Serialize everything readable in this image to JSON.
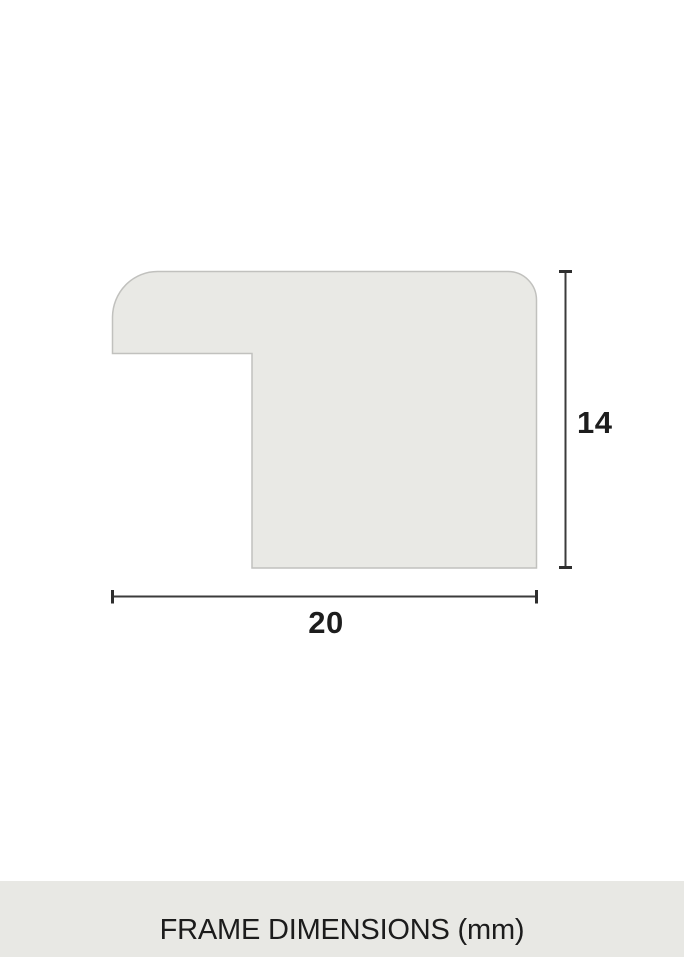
{
  "diagram": {
    "kind": "frame-profile-cross-section",
    "height_label": "14",
    "width_label": "20",
    "unit": "mm"
  },
  "footer": {
    "title": "FRAME DIMENSIONS (mm)"
  },
  "colors": {
    "background": "#ffffff",
    "shape_fill": "#e9e9e5",
    "shape_border": "#c1c1be",
    "dimension_line": "#3b3b3b",
    "dimension_text": "#1d1d1d",
    "footer_background": "#e8e8e4",
    "footer_text": "#1c1c1c"
  }
}
